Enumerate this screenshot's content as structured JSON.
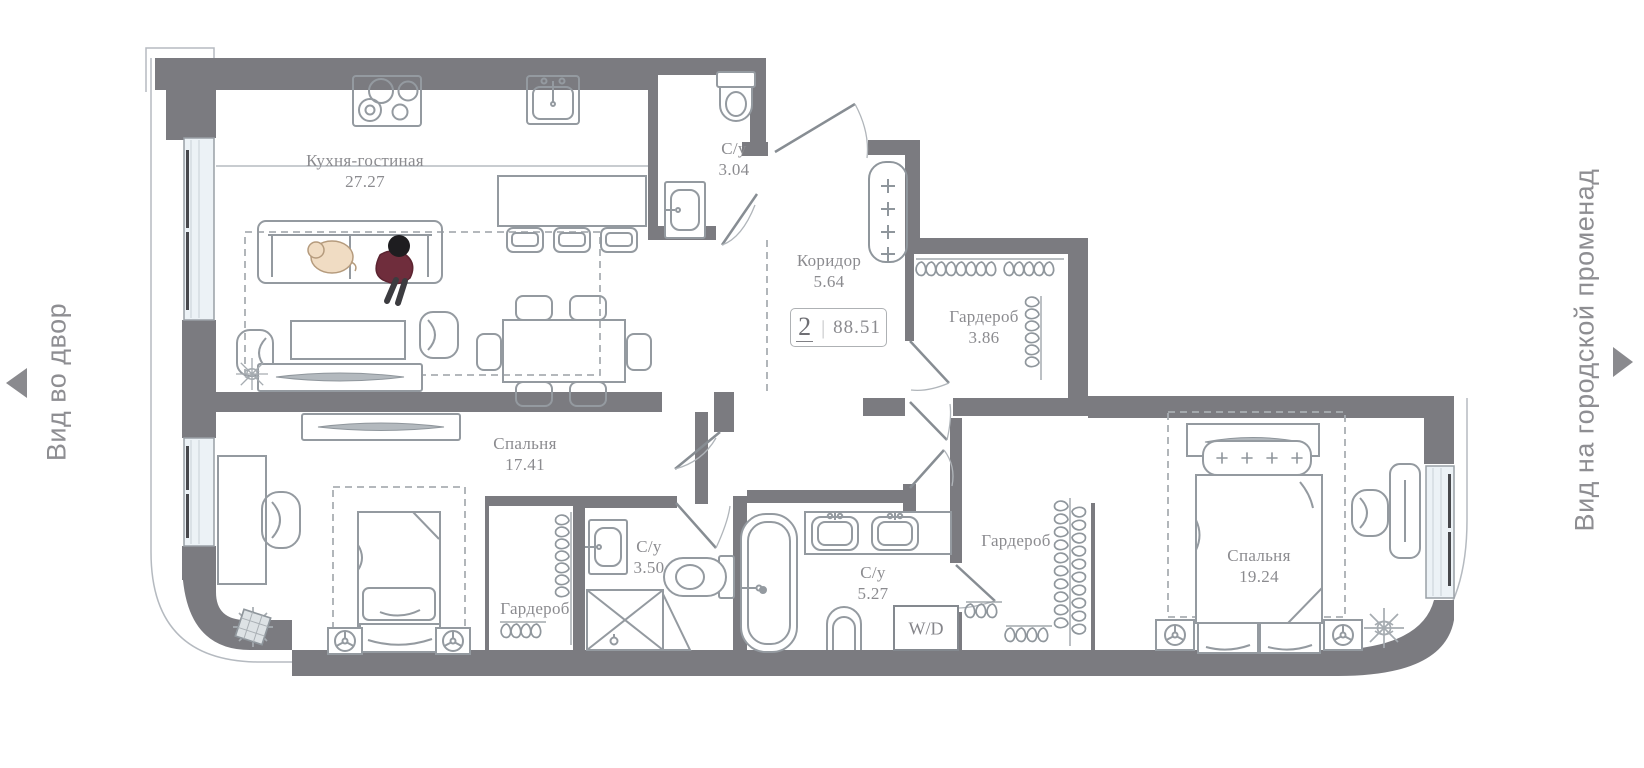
{
  "side_labels": {
    "left": "Вид во двор",
    "right": "Вид на городской променад"
  },
  "badge": {
    "rooms_count": "2",
    "divider": "|",
    "total_area": "88.51"
  },
  "rooms": [
    {
      "name": "Кухня-гостиная",
      "area": "27.27"
    },
    {
      "name": "С/у",
      "area": "3.04"
    },
    {
      "name": "Коридор",
      "area": "5.64"
    },
    {
      "name": "Гардероб",
      "area": "3.86"
    },
    {
      "name": "Спальня",
      "area": "17.41"
    },
    {
      "name": "Гардероб"
    },
    {
      "name": "С/у",
      "area": "3.50"
    },
    {
      "name": "С/у",
      "area": "5.27"
    },
    {
      "name": "Гардероб"
    },
    {
      "name": "Спальня",
      "area": "19.24"
    }
  ],
  "appliances": {
    "washer_dryer": "W/D"
  },
  "colors": {
    "wall": "#7b7b80",
    "label_text": "#8b8b8f",
    "furniture_line": "#949aa0",
    "window_fill": "#ecf2f6",
    "person_sweater": "#6f2d3c",
    "dog_fur": "#f0dcc3",
    "arrow": "#8a8a8e"
  }
}
